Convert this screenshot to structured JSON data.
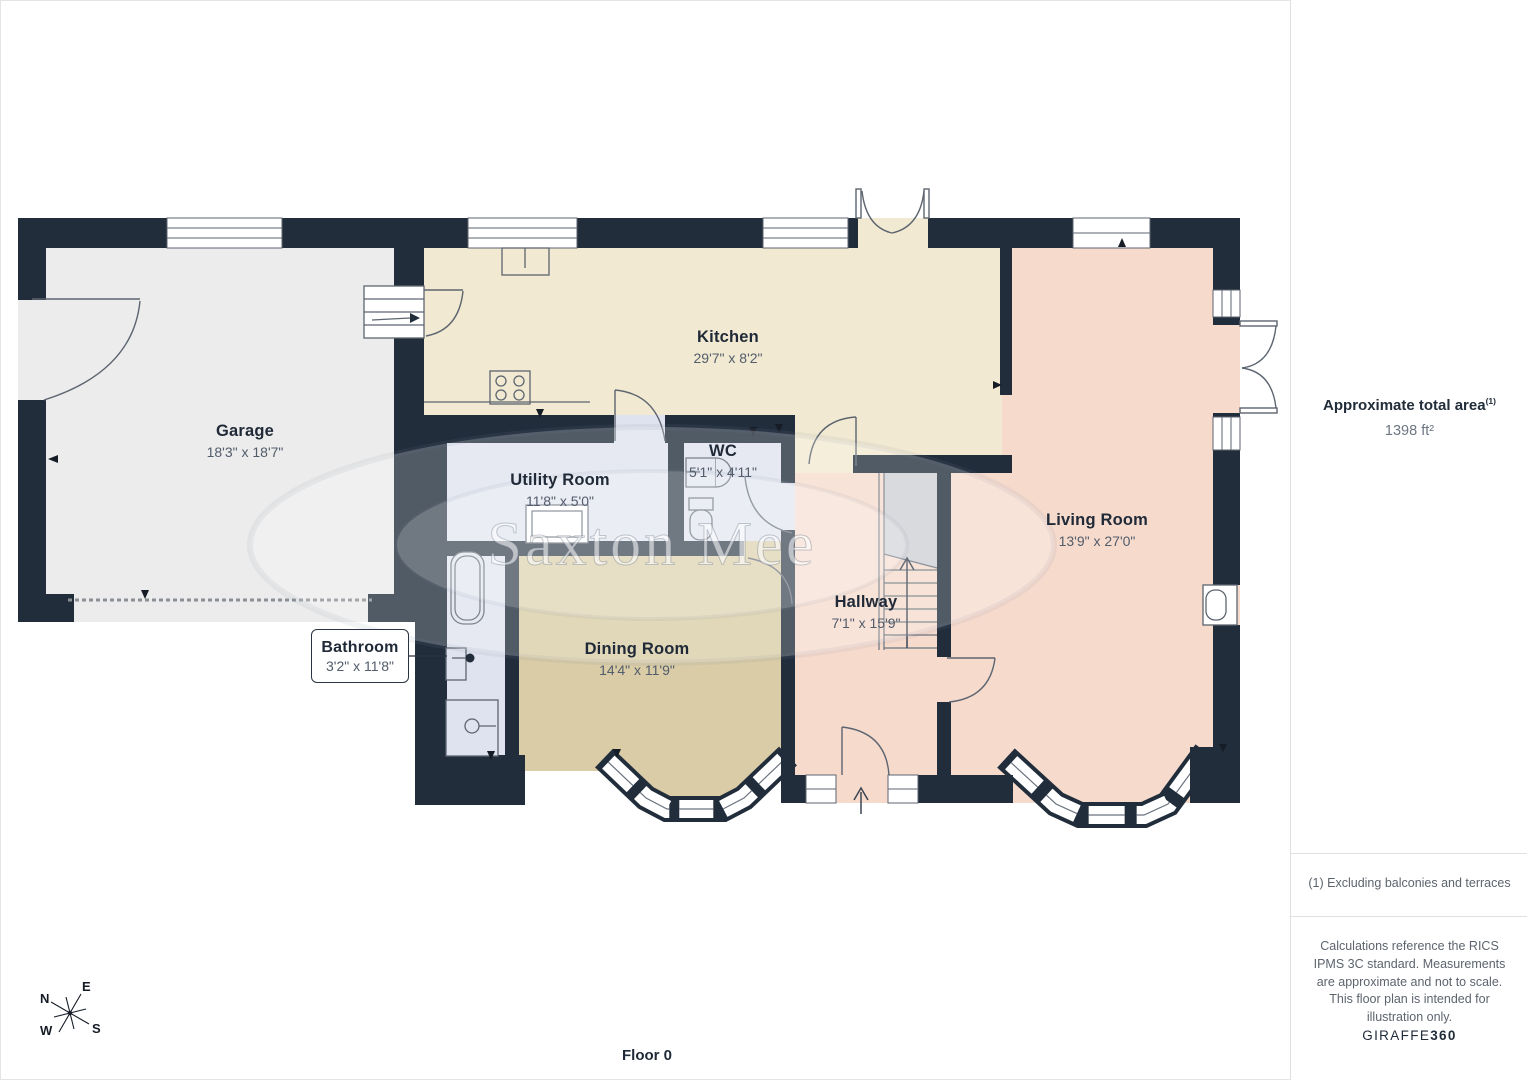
{
  "plan": {
    "floor_label": "Floor 0",
    "watermark": "Saxton Mee",
    "rooms": [
      {
        "name": "Garage",
        "dims": "18'3\" x 18'7\""
      },
      {
        "name": "Kitchen",
        "dims": "29'7\" x 8'2\""
      },
      {
        "name": "Utility Room",
        "dims": "11'8\" x 5'0\""
      },
      {
        "name": "WC",
        "dims": "5'1\" x 4'11\""
      },
      {
        "name": "Bathroom",
        "dims": "3'2\" x 11'8\""
      },
      {
        "name": "Dining Room",
        "dims": "14'4\" x 11'9\""
      },
      {
        "name": "Hallway",
        "dims": "7'1\" x 15'9\""
      },
      {
        "name": "Living Room",
        "dims": "13'9\" x 27'0\""
      }
    ],
    "compass": {
      "n": "N",
      "e": "E",
      "s": "S",
      "w": "W"
    }
  },
  "sidebar": {
    "area_title": "Approximate total area",
    "area_superscript": "(1)",
    "area_value": "1398 ft²",
    "footnote": "(1) Excluding balconies and terraces",
    "disclaimer": "Calculations reference the RICS IPMS 3C standard. Measurements are approximate and not to scale. This floor plan is intended for illustration only.",
    "brand": "GIRAFFE",
    "brand_suffix": "360"
  },
  "colors": {
    "wall": "#212d3b",
    "garage": "#ececec",
    "kitchen": "#f1e9d1",
    "living": "#f6dbcd",
    "dining": "#d9cca6",
    "wet_rooms": "#dfe3ef",
    "stairs": "#cdd0d4"
  }
}
